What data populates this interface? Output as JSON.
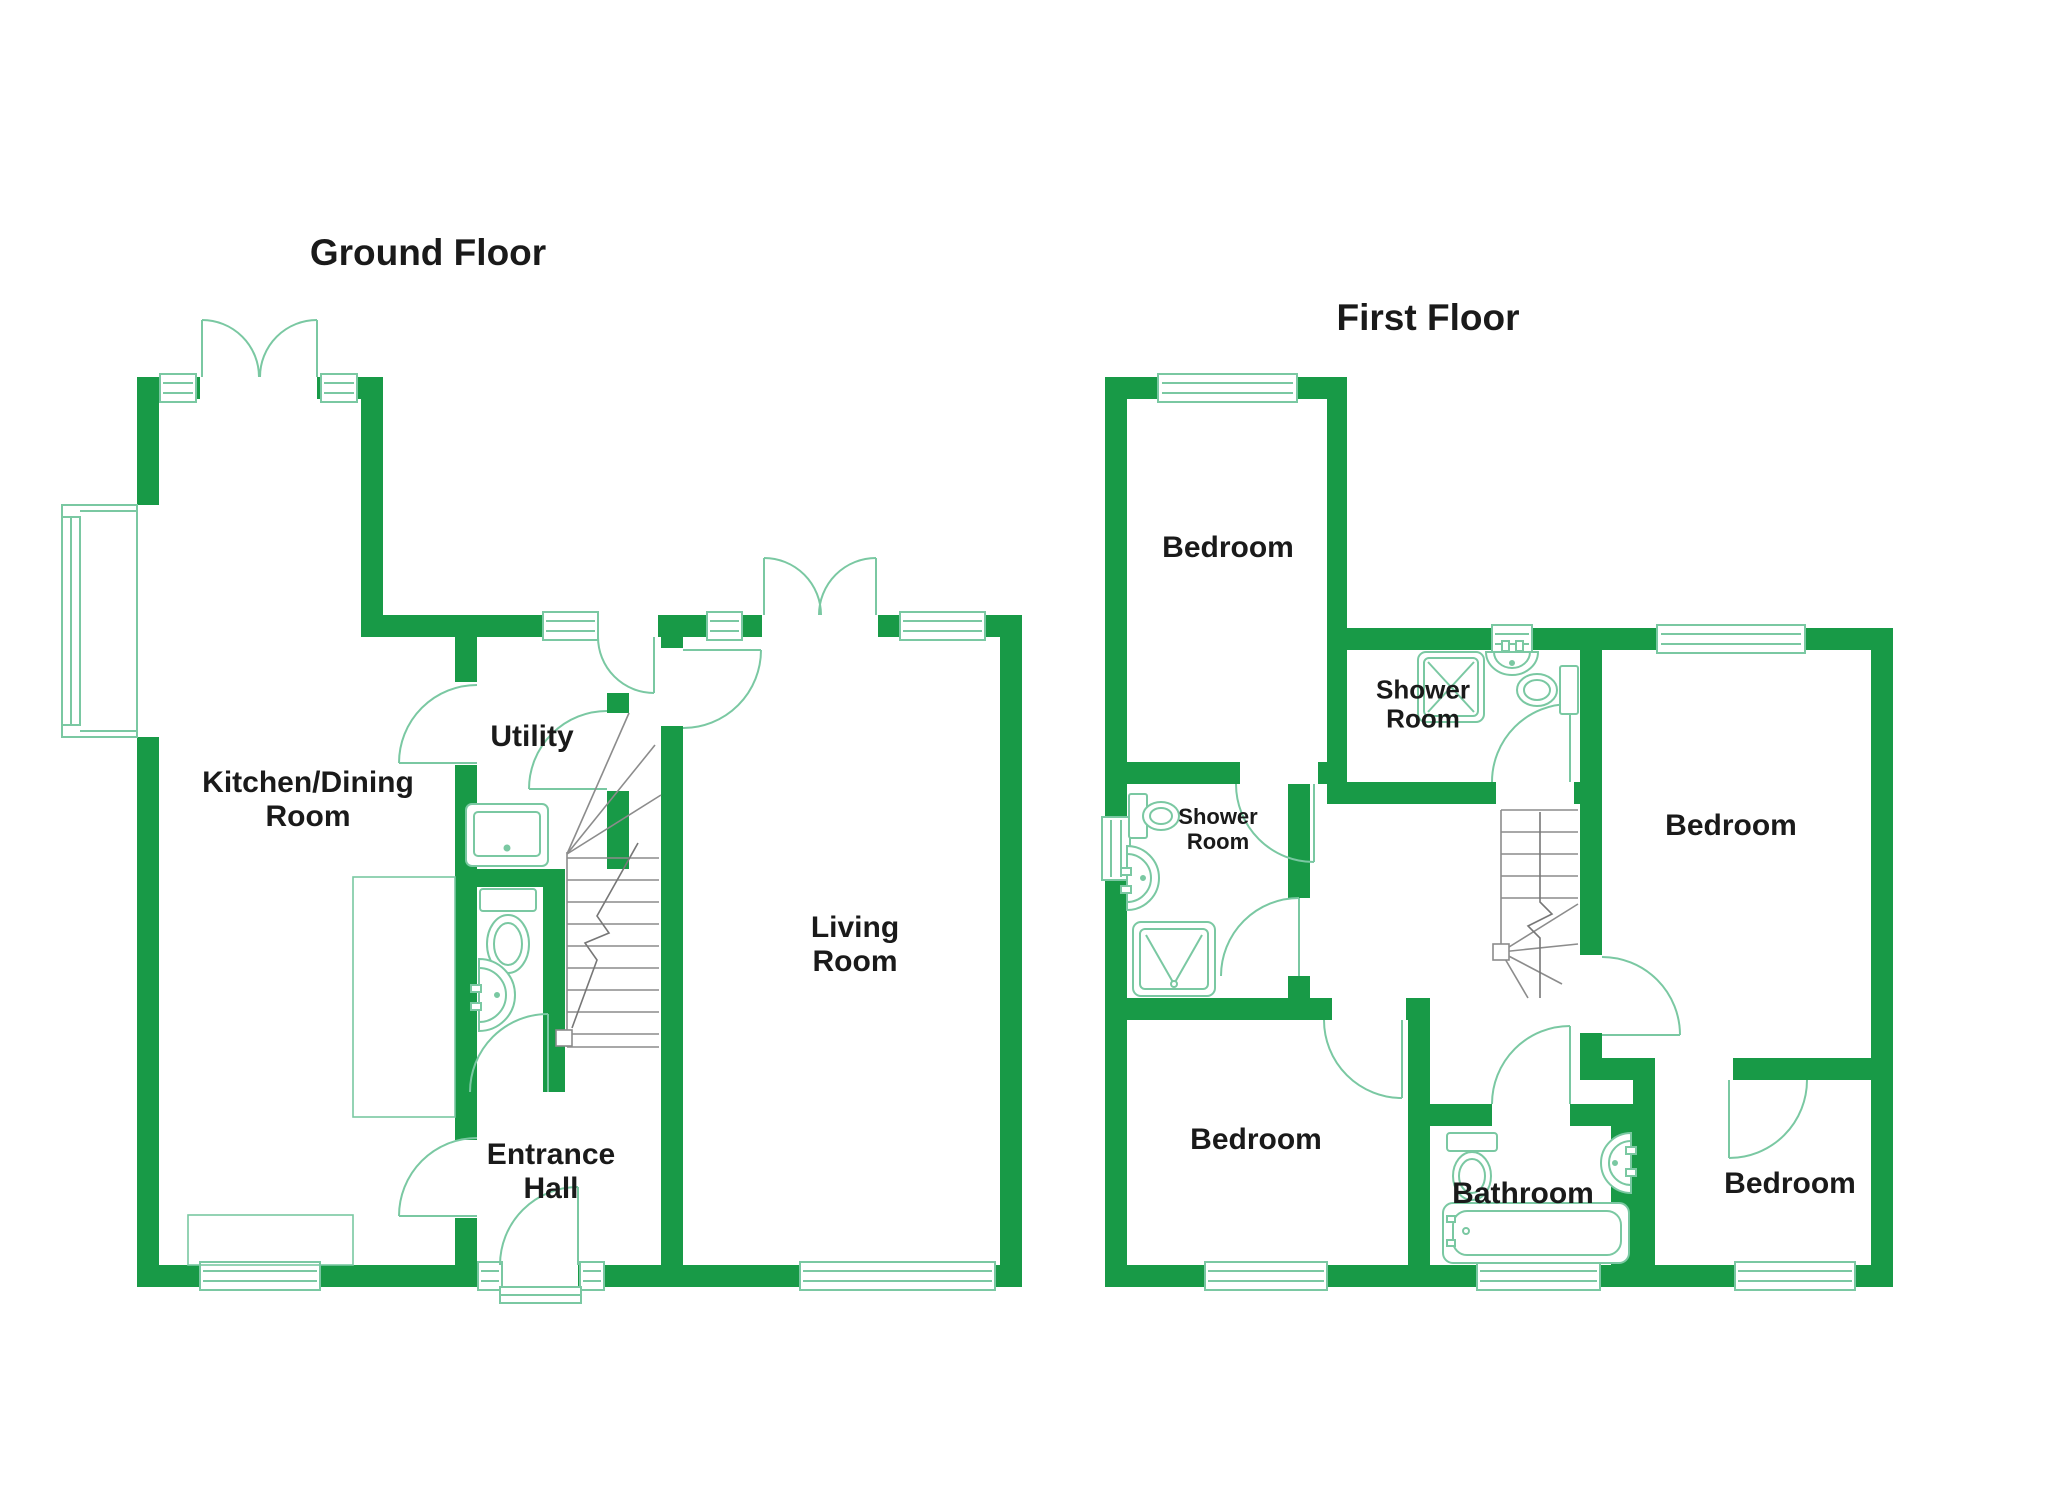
{
  "document_type": "floorplan",
  "colors": {
    "wall": "#189A47",
    "fixture": "#7AC8A2",
    "stairs": "#8C8C8C",
    "arrow": "#777777",
    "text": "#1A1A1A",
    "background": "#FFFFFF"
  },
  "floors": [
    {
      "title": "Ground Floor",
      "rooms": [
        {
          "label": "Kitchen/Dining\nRoom"
        },
        {
          "label": "Utility"
        },
        {
          "label": "Living\nRoom"
        },
        {
          "label": "Entrance\nHall"
        }
      ]
    },
    {
      "title": "First Floor",
      "rooms": [
        {
          "label": "Bedroom"
        },
        {
          "label": "Shower\nRoom"
        },
        {
          "label": "Bedroom"
        },
        {
          "label": "Shower\nRoom"
        },
        {
          "label": "Bedroom"
        },
        {
          "label": "Bathroom"
        },
        {
          "label": "Bedroom"
        }
      ]
    }
  ]
}
